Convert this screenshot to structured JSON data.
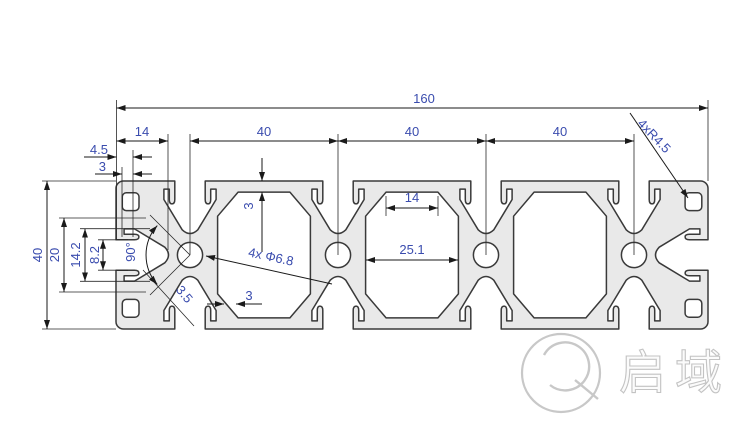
{
  "dims": {
    "overall": "160",
    "end_offset": "14",
    "pitch1": "40",
    "pitch2": "40",
    "pitch3": "40",
    "corner_radius": "4xR4.5",
    "end_wall": "4.5",
    "end_lip": "3",
    "height": "40",
    "slot_span": "20",
    "slot_cavity": "14.2",
    "slot_opening": "8.2",
    "web_angle": "90°",
    "web_thickness": "3.5",
    "bottom_wall": "3",
    "bore": "4x Φ6.8",
    "top_wall": "3",
    "cavity_top": "14",
    "cavity_width": "25.1"
  },
  "logo": {
    "brand": "启域"
  },
  "colors": {
    "profile_fill": "#e9e9e9",
    "outline": "#3a3a3a",
    "dimension_line": "#1a1a1a",
    "dimension_text": "#3a4cae",
    "logo_gray": "#c8c8c8"
  }
}
